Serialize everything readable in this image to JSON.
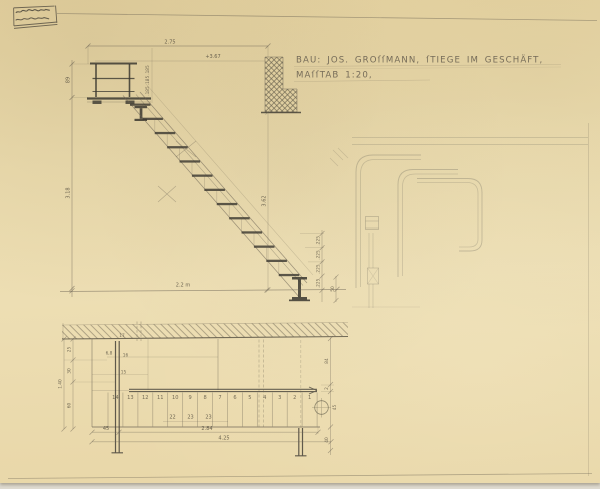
{
  "title": {
    "line1": "BAU: JOS. GROſſMANN, ſTIEGE IM GESCHÄFT,",
    "line2": "MAſſTAB 1:20,"
  },
  "elevation": {
    "dim_top": "2.75",
    "dim_level": "+3.67",
    "dim_rail_height": "89",
    "dim_total_height": "3.18",
    "dim_height_right": "3.62",
    "dim_riser": ".225",
    "dim_landing_riser": ".185",
    "dim_floor": "2.2 m",
    "dim_base": "50"
  },
  "plan": {
    "tread_numbers": [
      "14",
      "13",
      "12",
      "11",
      "10",
      "9",
      "8",
      "7",
      "6",
      "5",
      "4",
      "3",
      "2",
      "1"
    ],
    "tread_widths": [
      "22",
      "23",
      "23"
    ],
    "dim_wall": "17",
    "dim_left_outer": "1.40",
    "dims_left": [
      "25",
      "30",
      "60"
    ],
    "dims_landing": [
      "6,8",
      "16",
      "15"
    ],
    "dim_bottom_left": "45",
    "dim_bottom_run": "2.84",
    "dim_bottom_total": "4.25",
    "dims_right": [
      "84",
      "2",
      "45",
      "40"
    ]
  }
}
